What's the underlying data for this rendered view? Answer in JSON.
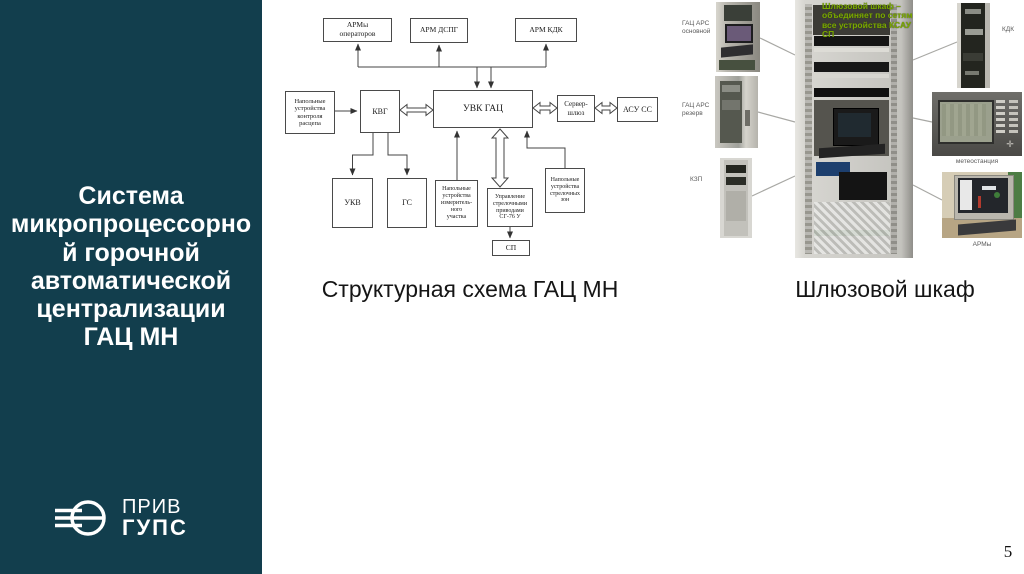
{
  "slide": {
    "title": "Система\nмикропроцессорно\nй горочной\nавтоматической\nцентрализации\nГАЦ МН",
    "page_number": "5"
  },
  "logo": {
    "prefix": "ПРИВ",
    "name": "ГУПС"
  },
  "diagram": {
    "caption": "Структурная схема ГАЦ МН",
    "boxes": {
      "arm_operators": "АРМы\nоператоров",
      "arm_dspg": "АРМ ДСПГ",
      "arm_kdk": "АРМ КДК",
      "field_uncoupling": "Напольные\nустройства\nконтроля\nрасцепа",
      "kvg": "КВГ",
      "uvk_gac": "УВК ГАЦ",
      "server_gateway": "Сервер-\nшлюз",
      "asu_ss": "АСУ СС",
      "ukv": "УКВ",
      "gs": "ГС",
      "field_measuring": "Напольные\nустройства\nизмеритель-\nного\nучастка",
      "turnout_control": "Управление\nстрелочными\nприводами\nСГ-76 У",
      "field_turnout_zones": "Напольные\nустройства\nстрелочных\nзон",
      "sp": "СП"
    }
  },
  "photos": {
    "caption": "Шлюзовой шкаф",
    "overlay_note": "Шлюзовой шкаф –\nобъединяет по сетям\nвсе устройства КСАУ СП",
    "labels": {
      "gac_ars_main": "ГАЦ АРС\nосновной",
      "gac_ars_reserve": "ГАЦ АРС\nрезерв",
      "kzp": "КЗП",
      "kdk": "КДК",
      "meteo": "метеостанция",
      "arm": "АРМы"
    }
  },
  "colors": {
    "sidebar": "#123e4d",
    "overlay_green": "#7aa800"
  }
}
